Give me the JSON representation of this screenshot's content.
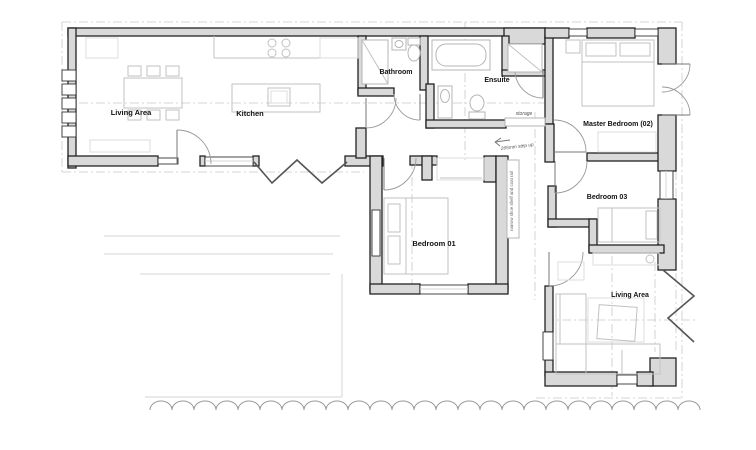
{
  "plan": {
    "title": "floor-plan",
    "labels": {
      "living_main": "Living Area",
      "kitchen": "Kitchen",
      "bathroom": "Bathroom",
      "ensuite": "Ensuite",
      "master_bedroom": "Master Bedroom (02)",
      "bedroom_03": "Bedroom 03",
      "bedroom_01": "Bedroom 01",
      "living_second": "Living Area",
      "storage": "storage"
    },
    "annotations": {
      "step_up": "265mm step up",
      "shoe_shelf": "narrow shoe shelf and coat rail"
    },
    "colors": {
      "wall_fill": "#d9d9d9",
      "wall_stroke": "#222222",
      "furniture": "#c2c2c2",
      "label": "#111111",
      "guide": "#c9c9c9",
      "hedge": "#9a9a9a",
      "bifold": "#555555"
    }
  }
}
